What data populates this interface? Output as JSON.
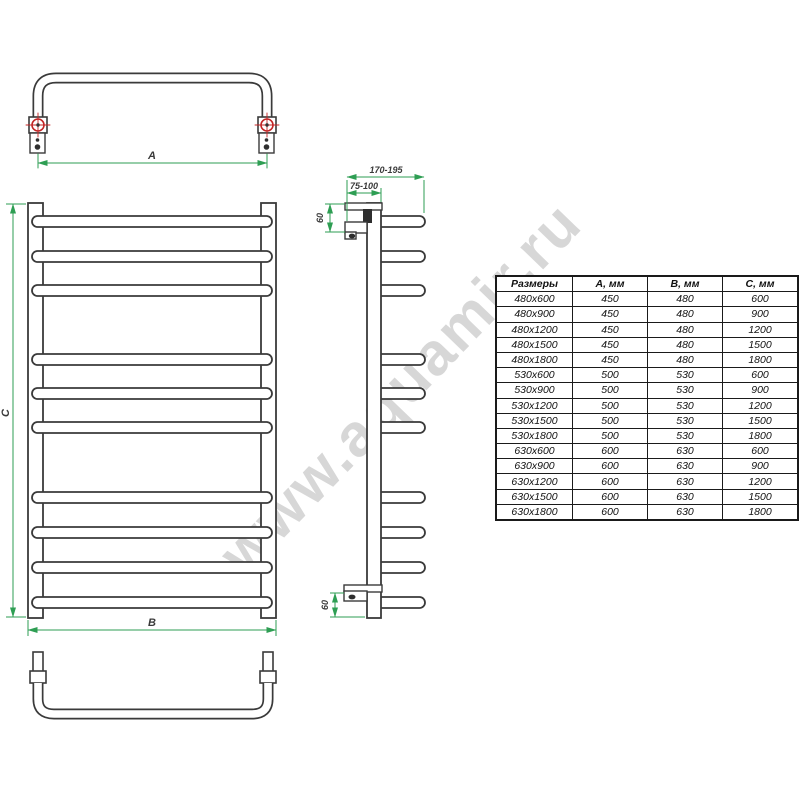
{
  "watermark": {
    "text": "www.aquamir.ru",
    "color": "#d7d7d7"
  },
  "colors": {
    "line": "#3a3a3a",
    "dimension_green": "#2e9e53",
    "marker_red": "#c42525"
  },
  "views": {
    "top_view": {
      "width_dim_label": "A"
    },
    "front_view": {
      "width_dim_label": "B",
      "height_dim_label": "C"
    },
    "side_view": {
      "depth_range_label": "170-195",
      "bracket_range_label": "75-100",
      "top_offset_label": "60",
      "bottom_offset_label": "60"
    }
  },
  "table": {
    "headers": [
      "Размеры",
      "А, мм",
      "В, мм",
      "С, мм"
    ],
    "rows": [
      [
        "480x600",
        "450",
        "480",
        "600"
      ],
      [
        "480x900",
        "450",
        "480",
        "900"
      ],
      [
        "480x1200",
        "450",
        "480",
        "1200"
      ],
      [
        "480x1500",
        "450",
        "480",
        "1500"
      ],
      [
        "480x1800",
        "450",
        "480",
        "1800"
      ],
      [
        "530x600",
        "500",
        "530",
        "600"
      ],
      [
        "530x900",
        "500",
        "530",
        "900"
      ],
      [
        "530x1200",
        "500",
        "530",
        "1200"
      ],
      [
        "530x1500",
        "500",
        "530",
        "1500"
      ],
      [
        "530x1800",
        "500",
        "530",
        "1800"
      ],
      [
        "630x600",
        "600",
        "630",
        "600"
      ],
      [
        "630x900",
        "600",
        "630",
        "900"
      ],
      [
        "630x1200",
        "600",
        "630",
        "1200"
      ],
      [
        "630x1500",
        "600",
        "630",
        "1500"
      ],
      [
        "630x1800",
        "600",
        "630",
        "1800"
      ]
    ]
  }
}
